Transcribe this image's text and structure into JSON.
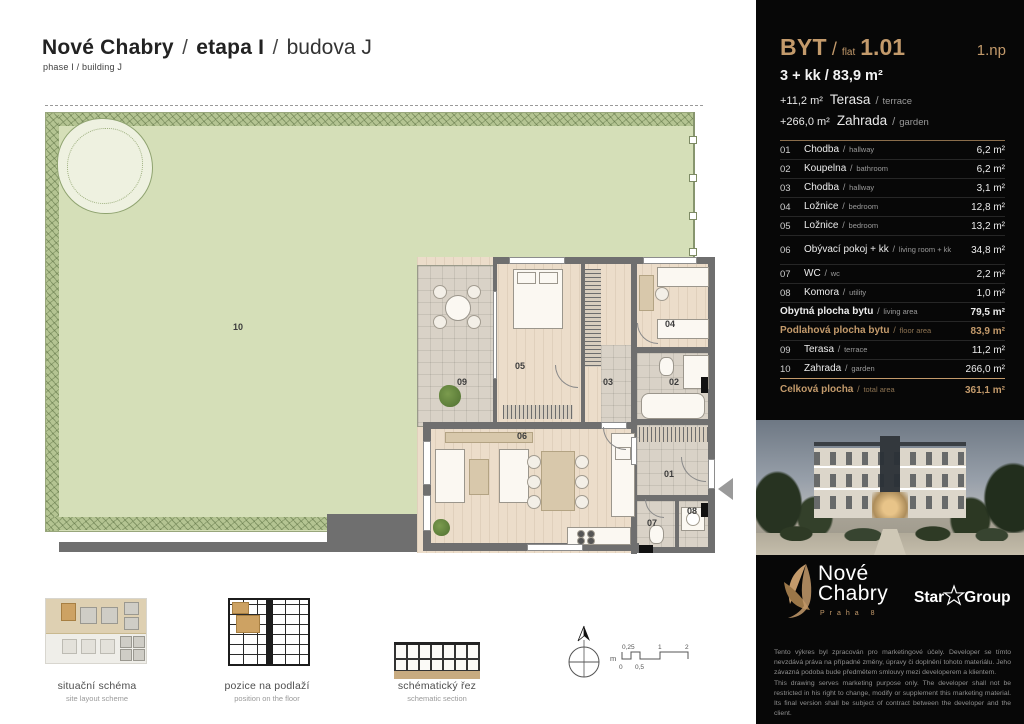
{
  "sep": "/",
  "title": {
    "project": "Nové Chabry",
    "stage": "etapa I",
    "building": "budova J",
    "subtitle": "phase I / building J"
  },
  "panel": {
    "header": {
      "byt": "BYT",
      "flat_word": "flat",
      "number": "1.01",
      "floor": "1.np",
      "disposition": "3 + kk / 83,9 m²",
      "terrace": {
        "area": "+11,2 m²",
        "cz": "Terasa",
        "en": "terrace"
      },
      "garden": {
        "area": "+266,0 m²",
        "cz": "Zahrada",
        "en": "garden"
      }
    },
    "rooms": [
      {
        "no": "01",
        "cz": "Chodba",
        "en": "hallway",
        "area": "6,2 m²"
      },
      {
        "no": "02",
        "cz": "Koupelna",
        "en": "bathroom",
        "area": "6,2 m²"
      },
      {
        "no": "03",
        "cz": "Chodba",
        "en": "hallway",
        "area": "3,1 m²"
      },
      {
        "no": "04",
        "cz": "Ložnice",
        "en": "bedroom",
        "area": "12,8 m²"
      },
      {
        "no": "05",
        "cz": "Ložnice",
        "en": "bedroom",
        "area": "13,2 m²"
      },
      {
        "no": "06",
        "cz": "Obývací pokoj + kk",
        "en": "living room + kk",
        "area": "34,8 m²"
      },
      {
        "no": "07",
        "cz": "WC",
        "en": "wc",
        "area": "2,2 m²"
      },
      {
        "no": "08",
        "cz": "Komora",
        "en": "utility",
        "area": "1,0 m²"
      },
      {
        "no": "",
        "cz": "Obytná plocha bytu",
        "en": "living area",
        "area": "79,5 m²"
      },
      {
        "no": "",
        "cz": "Podlahová plocha bytu",
        "en": "floor area",
        "area": "83,9 m²"
      },
      {
        "no": "09",
        "cz": "Terasa",
        "en": "terrace",
        "area": "11,2 m²"
      },
      {
        "no": "10",
        "cz": "Zahrada",
        "en": "garden",
        "area": "266,0 m²"
      },
      {
        "no": "",
        "cz": "Celková plocha",
        "en": "total area",
        "area": "361,1 m²"
      }
    ],
    "logos": {
      "nove": "Nové",
      "chabry": "Chabry",
      "praha": "Praha 8",
      "star": "Star",
      "group": "Group"
    },
    "legal": {
      "cz1": "Tento výkres byl zpracován pro marketingové účely. Developer se tímto nevzdává práva na případné změny, úpravy či doplnění tohoto materiálu. Jeho závazná podoba bude předmětem smlouvy mezi developerem a klientem.",
      "en1": "This drawing serves marketing purpose only. The developer shall not be restricted in his right to change, modify or supplement this marketing material. Its final version shall be subject of contract between the developer and the client.",
      "cz2": "Podlahová plocha bytu (ateliéru) je měřena dle nařízení vlády 366/2013 Sb.",
      "en2": "The floor area of the apartment (atelier) is measured according to the Government Degree No. 366/2013 Coll."
    }
  },
  "plan": {
    "labels": {
      "r01": "01",
      "r02": "02",
      "r03": "03",
      "r04": "04",
      "r05": "05",
      "r06": "06",
      "r07": "07",
      "r08": "08",
      "r09": "09",
      "r10": "10"
    }
  },
  "thumbs": {
    "site": {
      "cz": "situační schéma",
      "en": "site layout scheme"
    },
    "floor": {
      "cz": "pozice na podlaží",
      "en": "position on the floor"
    },
    "section": {
      "cz": "schématický řez",
      "en": "schematic section"
    }
  },
  "scale": {
    "unit": "m",
    "t1": "0,25",
    "t2": "1",
    "t3": "2",
    "b1": "0",
    "b2": "0,5"
  }
}
